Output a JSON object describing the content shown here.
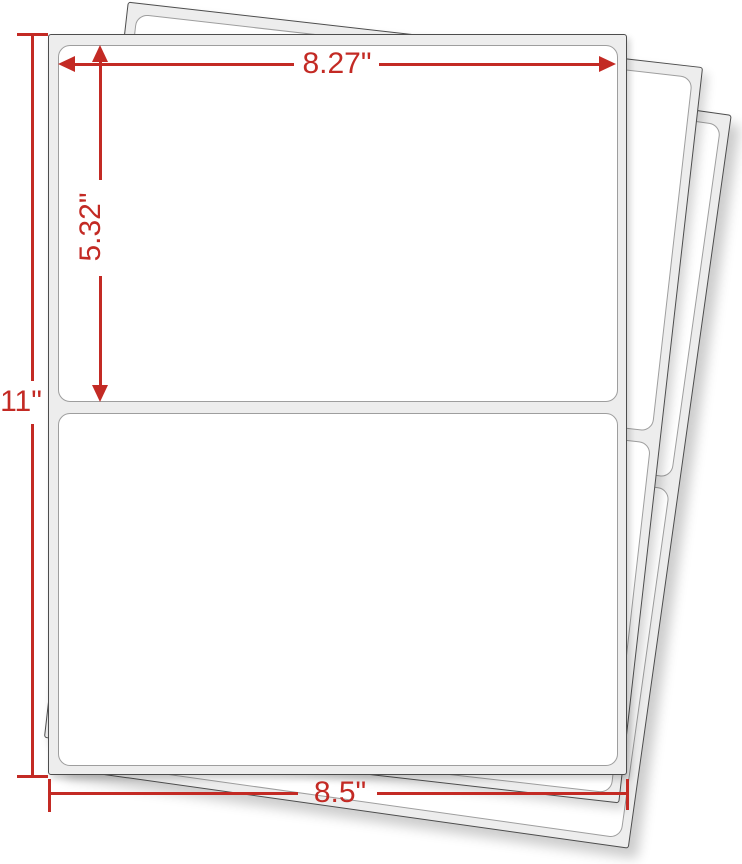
{
  "figure": {
    "kind": "label-sheet-dimension-diagram",
    "accent_color": "#c32a24",
    "sheet_fill": "#ededed",
    "label_fill": "#ffffff",
    "sheets_visible": 3,
    "labels_per_sheet": 2,
    "dimensions": {
      "label_width": "8.27\"",
      "label_height": "5.32\"",
      "sheet_height": "11\"",
      "sheet_width": "8.5\""
    }
  }
}
